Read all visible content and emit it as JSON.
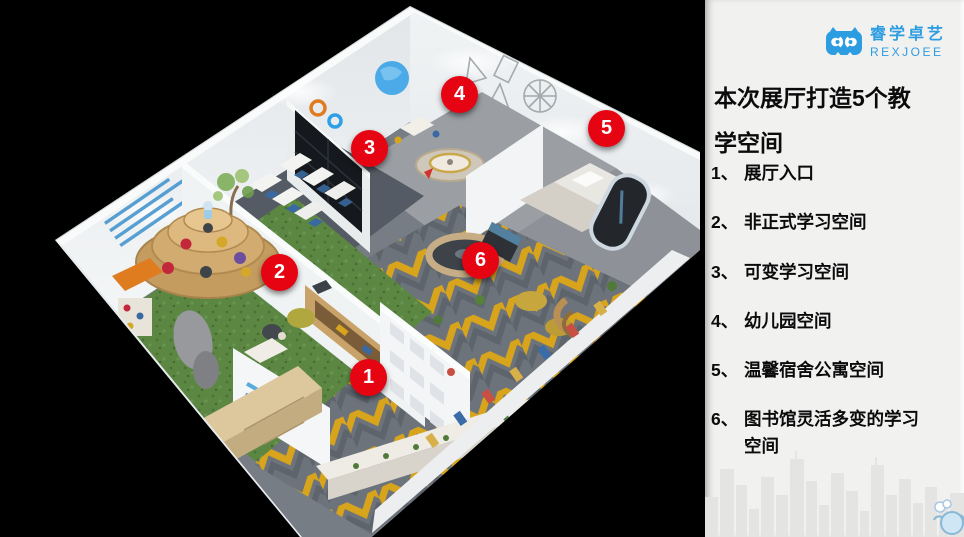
{
  "panel": {
    "logo": {
      "brand_cn": "睿学卓艺",
      "brand_en": "REXJOEE",
      "color": "#2d9de2",
      "icon": "owl-logo-icon"
    },
    "title": "本次展厅打造5个教学空间",
    "legend": [
      {
        "num": "1、",
        "label": "展厅入口"
      },
      {
        "num": "2、",
        "label": "非正式学习空间"
      },
      {
        "num": "3、",
        "label": "可变学习空间"
      },
      {
        "num": "4、",
        "label": "幼儿园空间"
      },
      {
        "num": "5、",
        "label": "温馨宿舍公寓空间"
      },
      {
        "num": "6、",
        "label": "图书馆灵活多变的学习空间"
      }
    ]
  },
  "scene": {
    "description_markers": "red numbered callout circles over 3D exhibition-hall render",
    "marker_color": "#e60413",
    "markers": [
      {
        "num": "1"
      },
      {
        "num": "2"
      },
      {
        "num": "3"
      },
      {
        "num": "4"
      },
      {
        "num": "5"
      },
      {
        "num": "6"
      }
    ],
    "colors": {
      "accent_yellow": "#d8a41c",
      "grass_green": "#5b8743",
      "carpet_gray": "#6d737b",
      "wall_light": "#eef1f3",
      "panel_bg": "#f1f1f0"
    }
  }
}
